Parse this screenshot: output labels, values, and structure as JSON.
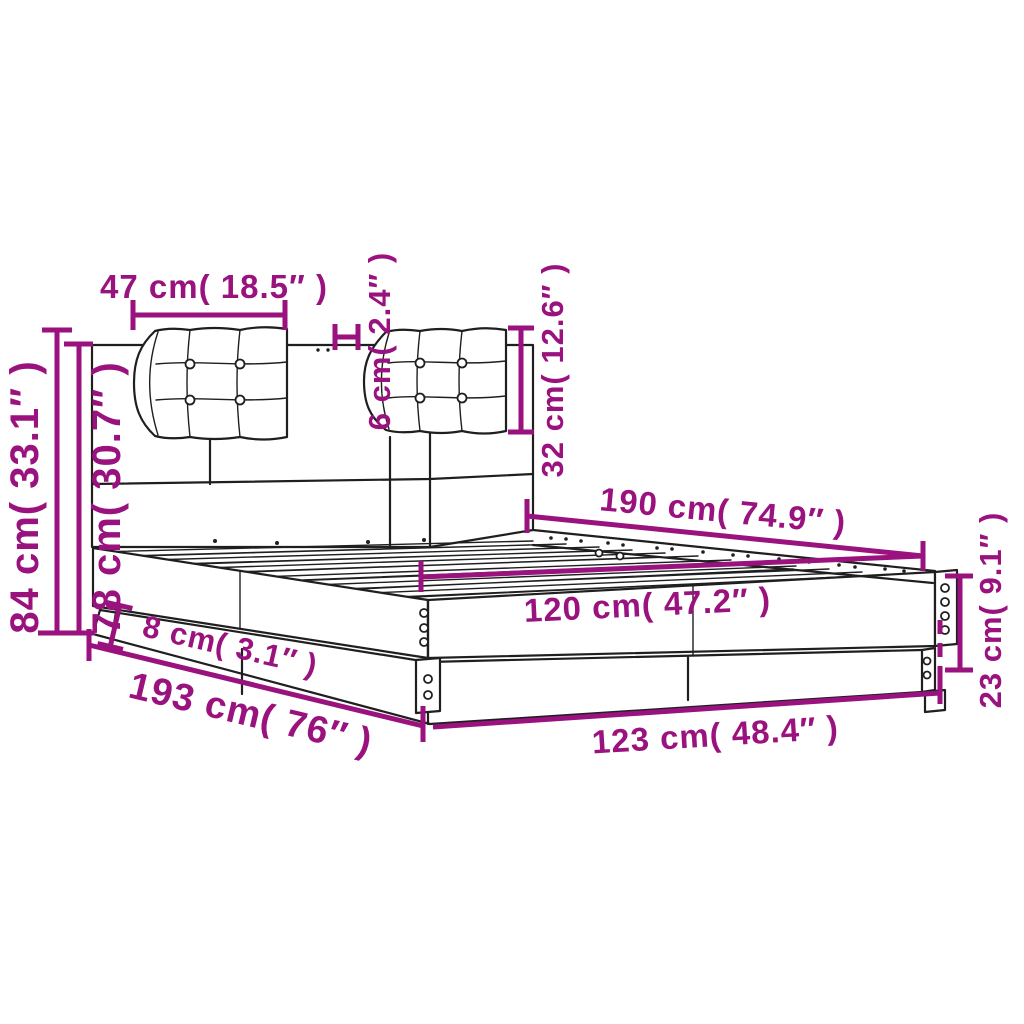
{
  "diagram": {
    "type": "product-dimension-diagram",
    "subject": "bed frame with headboard and two tufted cushions, perspective line drawing",
    "colors": {
      "dimension_accent": "#9A127E",
      "outline": "#1f1f1f",
      "background": "#ffffff"
    },
    "labels": {
      "cushion_width": "47 cm( 18.5″ )",
      "cushion_thickness": "6 cm( 2.4″ )",
      "cushion_height": "32 cm( 12.6″ )",
      "total_height": "84 cm( 33.1″ )",
      "headboard_height": "78 cm( 30.7″ )",
      "bed_length_inner": "190 cm( 74.9″ )",
      "bed_width_inner": "120 cm( 47.2″ )",
      "plinth_height": "8 cm( 3.1″ )",
      "bed_length_outer": "193 cm( 76″ )",
      "bed_width_outer": "123 cm( 48.4″ )",
      "base_height": "23 cm( 9.1″ )"
    }
  }
}
